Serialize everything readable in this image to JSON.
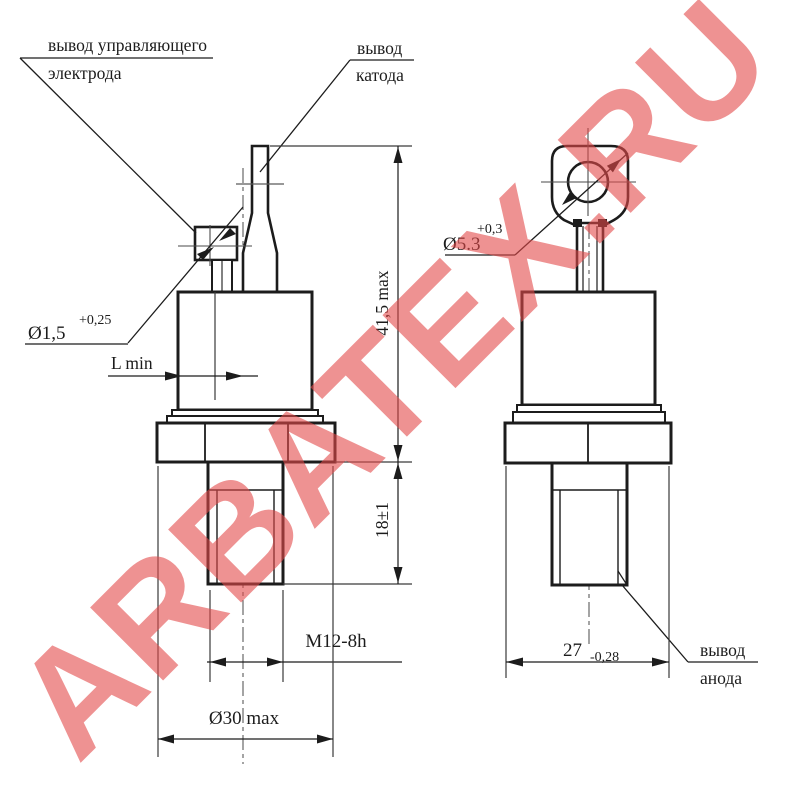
{
  "watermark": {
    "text": "ARBATEX.RU",
    "color": "#E24A4A"
  },
  "drawing": {
    "line_color": "#1c1c1c",
    "background": "#ffffff"
  },
  "labels": {
    "gate_lead": {
      "line1": "вывод управляющего",
      "line2": "электрода"
    },
    "cathode_lead": {
      "line1": "вывод",
      "line2": "катода"
    },
    "anode_lead": {
      "line1": "вывод",
      "line2": "анода"
    }
  },
  "dimensions": {
    "gate_wire_dia": {
      "value": "Ø1,5",
      "tolerance": "+0,25"
    },
    "gate_length": "L min",
    "overall_height": "41,5 max",
    "stud_length": "18±1",
    "thread": "M12-8h",
    "body_dia": "Ø30 max",
    "lug_hole_dia": {
      "value": "Ø5.3",
      "tolerance": "+0,3"
    },
    "flange_width": {
      "value": "27",
      "tolerance": "-0,28"
    }
  }
}
